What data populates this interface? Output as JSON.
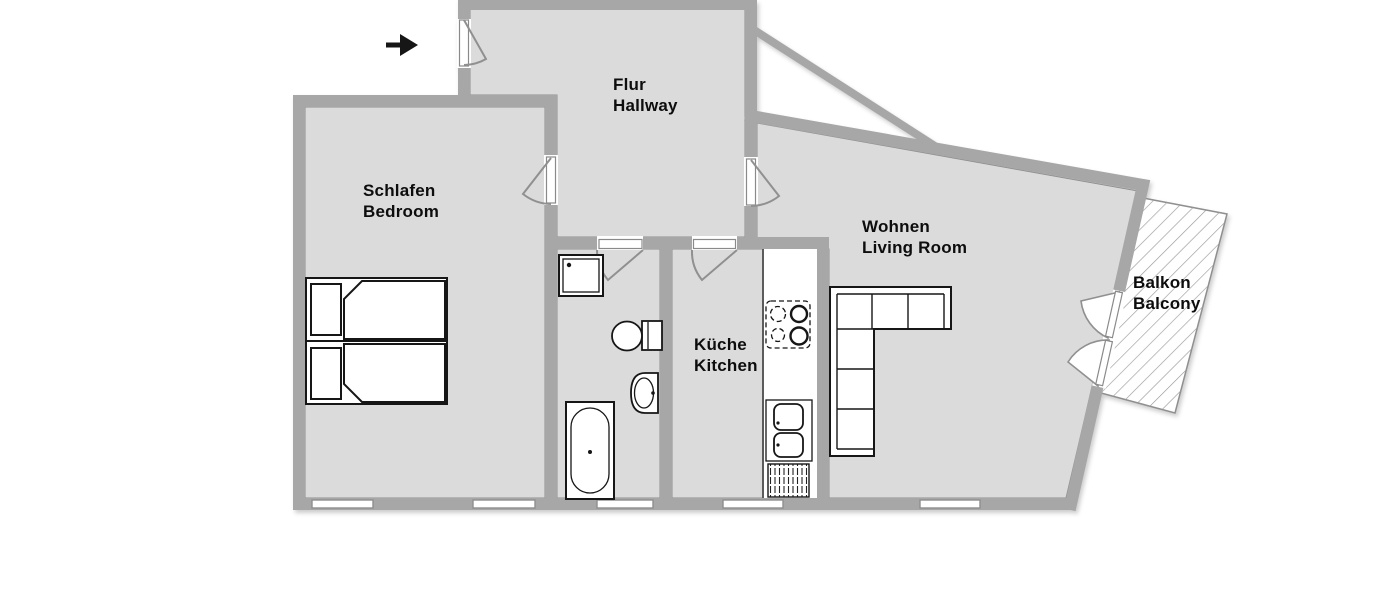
{
  "title": "Apartment floor plan",
  "colors": {
    "floor": "#dbdbdb",
    "wall": "#a7a7a7",
    "wall_edge": "#8f8f8f",
    "outline": "#161616",
    "white": "#ffffff",
    "hatch": "#9a9a9a",
    "label": "#0d0d0d",
    "swing": "#909090"
  },
  "rooms": {
    "hallway": {
      "de": "Flur",
      "en": "Hallway"
    },
    "bedroom": {
      "de": "Schlafen",
      "en": "Bedroom"
    },
    "living": {
      "de": "Wohnen",
      "en": "Living Room"
    },
    "kitchen": {
      "de": "Küche",
      "en": "Kitchen"
    },
    "balcony": {
      "de": "Balkon",
      "en": "Balcony"
    }
  },
  "icons": {
    "entrance": "entrance-arrow-icon",
    "fixtures": [
      "double-bed",
      "l-shaped-sofa",
      "shower",
      "toilet",
      "washbasin",
      "bathtub",
      "kitchen-counter",
      "stove",
      "kitchen-sink",
      "radiator"
    ]
  }
}
